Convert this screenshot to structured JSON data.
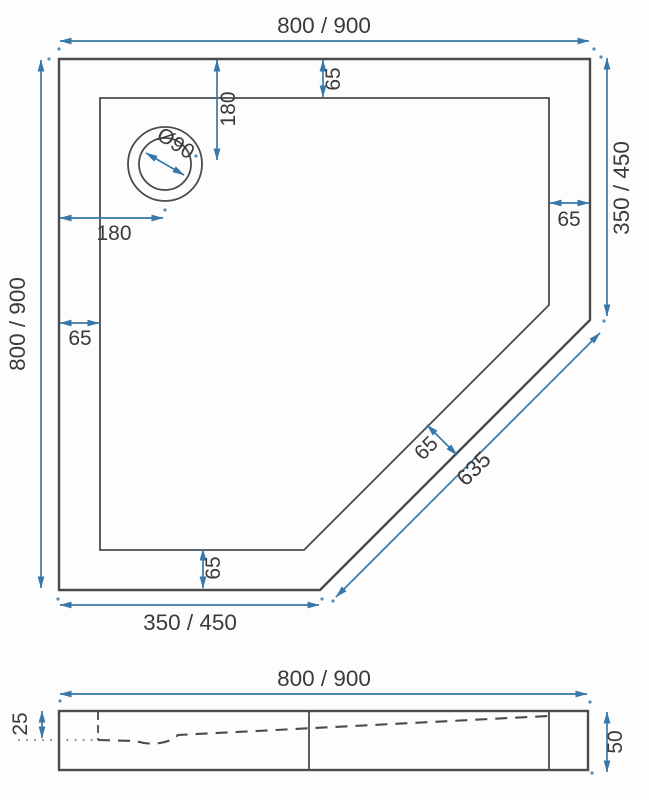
{
  "drawing": {
    "type": "shower-tray technical drawing, pentagonal top view with side section view"
  },
  "colors": {
    "line": "#4a4b4f",
    "dim": "#3878a8",
    "text": "#3a3a3c",
    "bg": "#fdfdfd"
  },
  "top_view": {
    "overall_width": "800 / 900",
    "overall_height": "800 / 900",
    "right_side": "350 / 450",
    "bottom_side": "350 / 450",
    "diagonal_length": "635",
    "rim_top": "65",
    "rim_left": "65",
    "rim_right": "65",
    "rim_bottom": "65",
    "rim_diagonal": "65",
    "drain_diameter": "Ø90",
    "drain_from_left": "180",
    "drain_from_top": "180"
  },
  "side_view": {
    "overall_width": "800 / 900",
    "rim_height": "25",
    "total_height": "50"
  }
}
